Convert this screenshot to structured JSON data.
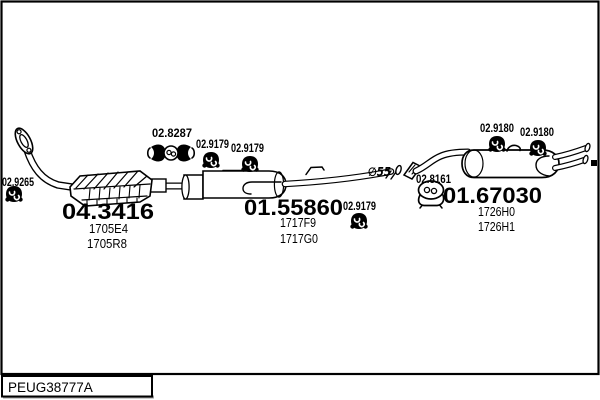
{
  "diagram": {
    "code": "PEUG38777A",
    "diameter_note": "∅55",
    "parts": {
      "front_clamp": {
        "number": "02.9265"
      },
      "front_hanger": {
        "number": "02.8287"
      },
      "mid_clamp_1": {
        "number": "02.9179"
      },
      "mid_clamp_2": {
        "number": "02.9179"
      },
      "mid_clamp_3": {
        "number": "02.9179"
      },
      "rear_clamp_1": {
        "number": "02.9180"
      },
      "rear_clamp_2": {
        "number": "02.9180"
      },
      "rear_hanger": {
        "number": "02.8161"
      },
      "catalyst": {
        "number": "04.3416",
        "variants": [
          "1705E4",
          "1705R8"
        ]
      },
      "mid_muffler": {
        "number": "01.55860",
        "variants": [
          "1717F9",
          "1717G0"
        ]
      },
      "rear_muffler": {
        "number": "01.67030",
        "variants": [
          "1726H0",
          "1726H1"
        ]
      }
    }
  }
}
